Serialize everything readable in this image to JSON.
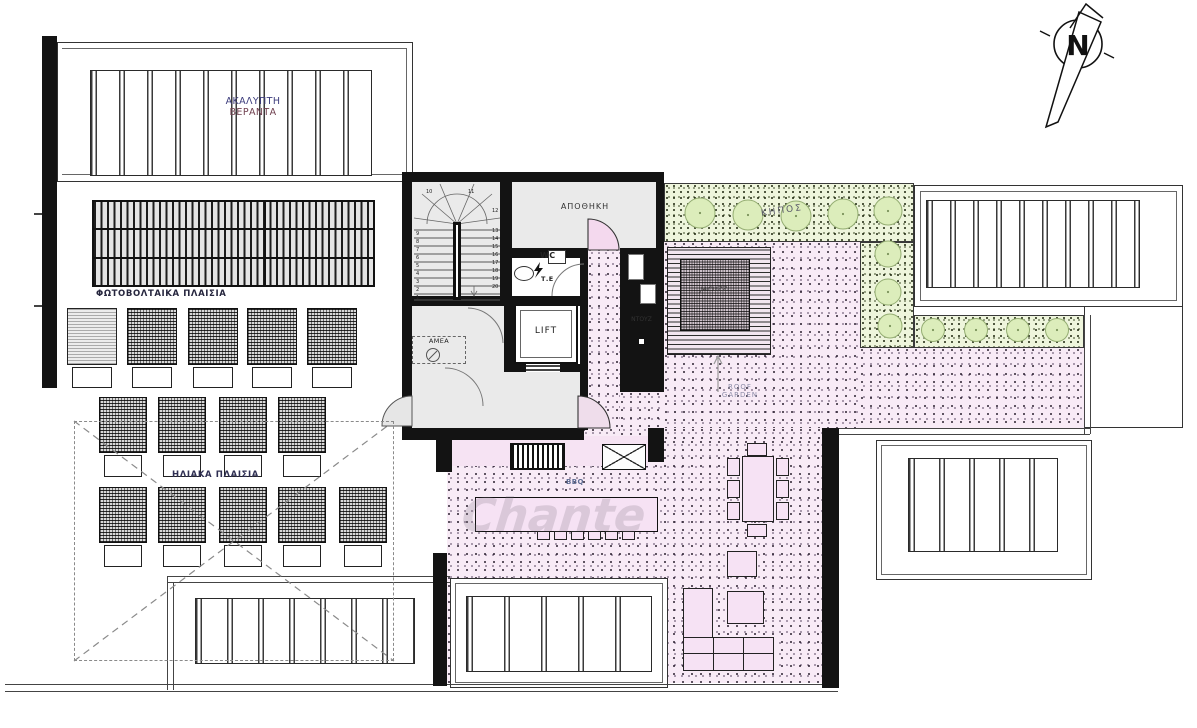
{
  "labels": {
    "veranda_line1": "ΑΚΑΛΥΠΤΗ",
    "veranda_line2": "ΒΕΡΑΝΤΑ",
    "photovoltaic": "ΦΩΤΟΒΟΛΤΑΙΚΑ ΠΛΑΙΣΙΑ",
    "solar": "ΗΛΙΑΚΑ ΠΛΑΙΣΙΑ",
    "storage": "ΑΠΟΘΗΚΗ",
    "wc": "WC",
    "electrical_panel": "Τ.Ε",
    "lift": "LIFT",
    "disabled": "ΑΜΕΑ",
    "shower": "ΝΤΟΥΖ",
    "garden": "ΚΗΠΟΣ",
    "jacuzzi": "JACUZZI",
    "roof_line1": "ROOF",
    "roof_line2": "GARDEN",
    "bbq": "BBQ",
    "north": "N",
    "watermark": "Chante"
  },
  "stairs": {
    "numbers": [
      "1",
      "2",
      "3",
      "4",
      "5",
      "6",
      "7",
      "8",
      "9",
      "10",
      "11",
      "12",
      "13",
      "14",
      "15",
      "16",
      "17",
      "18",
      "19",
      "20"
    ]
  },
  "colors": {
    "wall": "#131313",
    "roof_garden_pink": "#f8ebf6",
    "garden_green": "#eef5dc",
    "bush_green": "#dcedbb",
    "room_gray": "#eaeaea",
    "door_pink": "#f4d9ee"
  }
}
